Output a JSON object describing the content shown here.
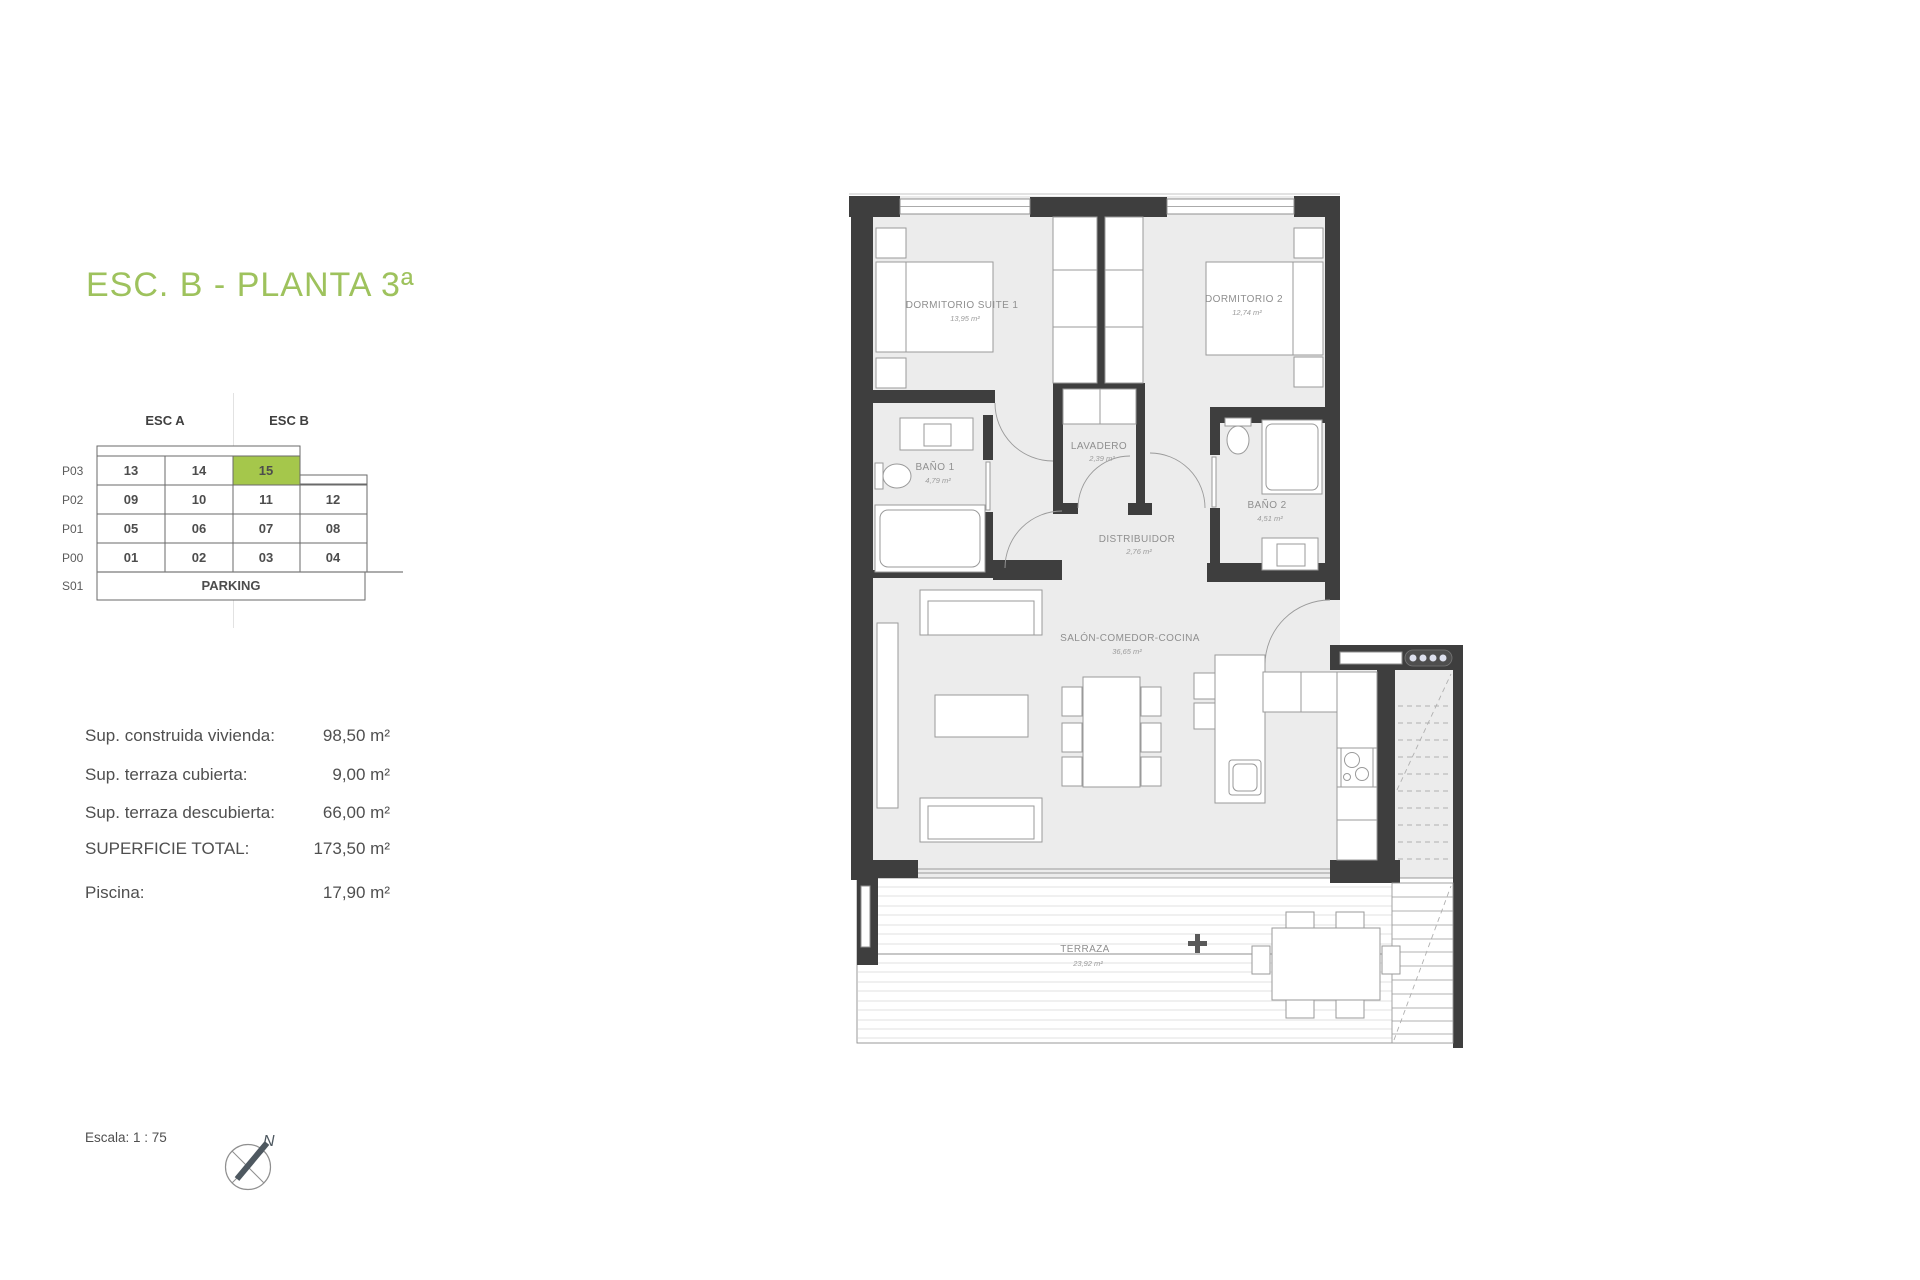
{
  "title": {
    "text": "ESC. B - PLANTA 3ª",
    "color": "#9ec25d"
  },
  "unit_table": {
    "headers": [
      "ESC A",
      "ESC B"
    ],
    "row_labels": [
      "P03",
      "P02",
      "P01",
      "P00",
      "S01"
    ],
    "cells": {
      "P03": [
        "13",
        "14",
        "15"
      ],
      "P02": [
        "09",
        "10",
        "11",
        "12"
      ],
      "P01": [
        "05",
        "06",
        "07",
        "08"
      ],
      "P00": [
        "01",
        "02",
        "03",
        "04"
      ],
      "S01": [
        "PARKING"
      ]
    },
    "highlighted_unit": "15",
    "highlight_color": "#a5c74b"
  },
  "measurements": {
    "rows": [
      {
        "label": "Sup. construida vivienda:",
        "value": "98,50 m²"
      },
      {
        "label": "Sup. terraza cubierta:",
        "value": "9,00 m²"
      },
      {
        "label": "Sup. terraza descubierta:",
        "value": "66,00 m²"
      },
      {
        "label": "SUPERFICIE TOTAL:",
        "value": "173,50 m²"
      },
      {
        "label": "Piscina:",
        "value": "17,90 m²"
      }
    ]
  },
  "scale": {
    "label": "Escala: 1 : 75"
  },
  "compass": {
    "north_label": "N"
  },
  "floorplan": {
    "wall_color": "#3e3e3e",
    "floor_color": "#ececec",
    "rooms": {
      "suite1": {
        "name": "DORMITORIO SUITE 1",
        "area": "13,95 m²"
      },
      "dorm2": {
        "name": "DORMITORIO 2",
        "area": "12,74 m²"
      },
      "bano1": {
        "name": "BAÑO 1",
        "area": "4,79 m²"
      },
      "lavadero": {
        "name": "LAVADERO",
        "area": "2,39 m²"
      },
      "distribuidor": {
        "name": "DISTRIBUIDOR",
        "area": "2,76 m²"
      },
      "bano2": {
        "name": "BAÑO 2",
        "area": "4,51 m²"
      },
      "salon": {
        "name": "SALÓN-COMEDOR-COCINA",
        "area": "36,65 m²"
      },
      "terraza": {
        "name": "TERRAZA",
        "area": "23,92 m²"
      }
    }
  }
}
